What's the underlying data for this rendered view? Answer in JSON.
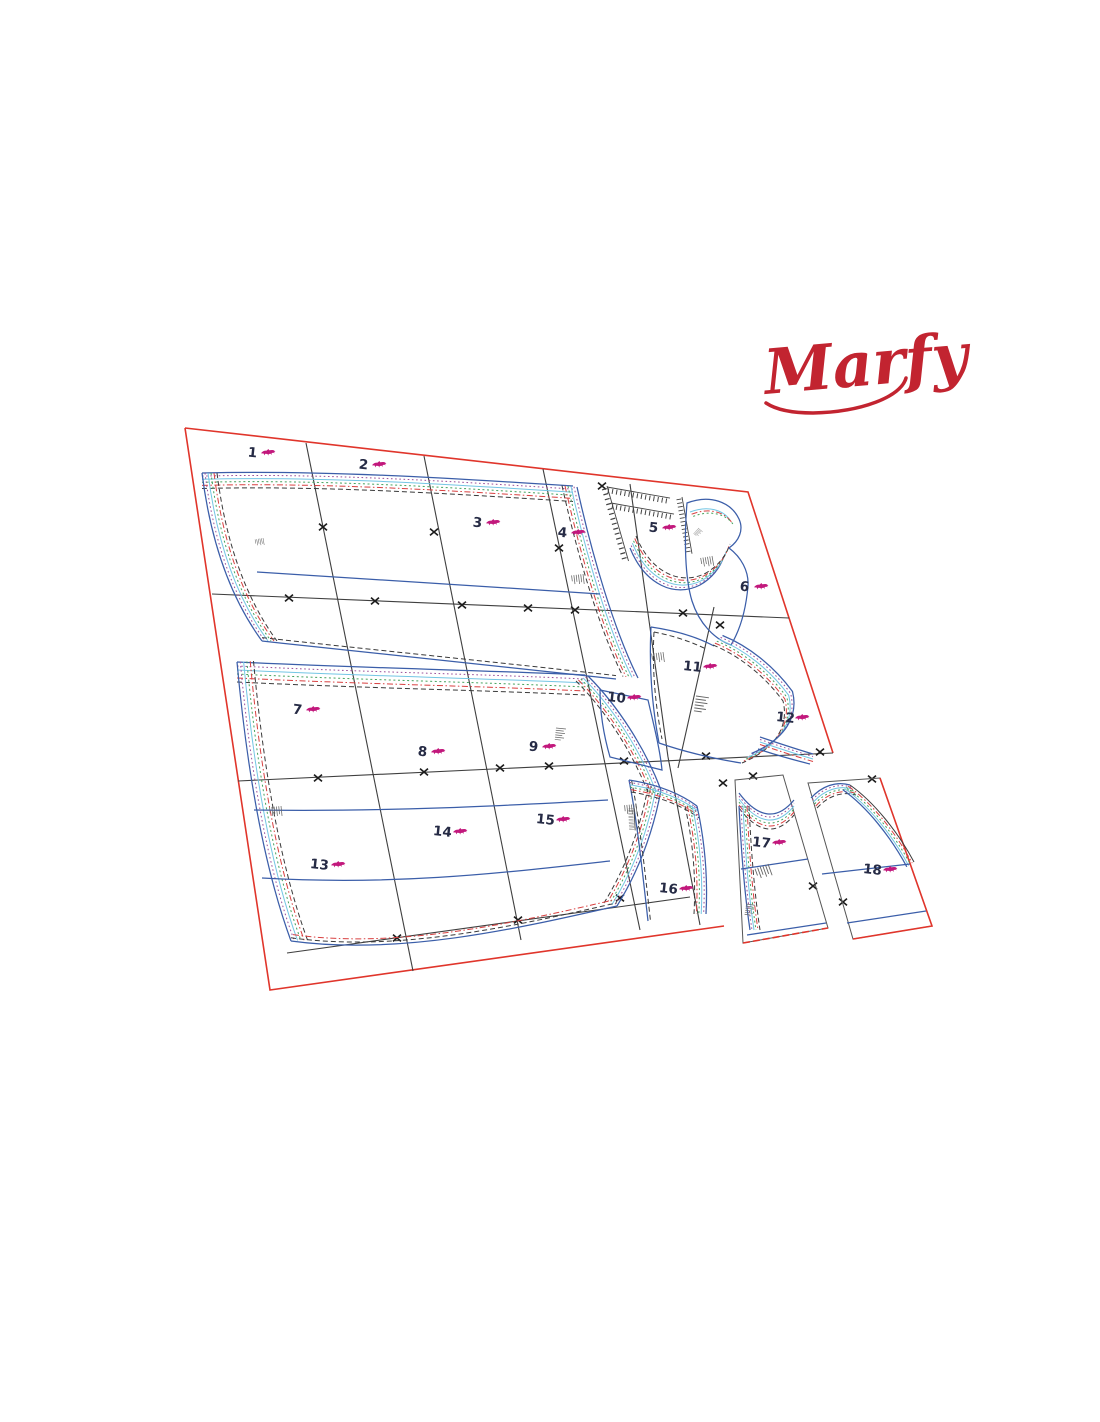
{
  "logo": {
    "text": "Marfy",
    "color": "#c22430"
  },
  "sheet": {
    "piece_numbers": [
      "1",
      "2",
      "3",
      "4",
      "5",
      "6",
      "7",
      "8",
      "9",
      "10",
      "11",
      "12",
      "13",
      "14",
      "15",
      "16",
      "17",
      "18"
    ],
    "border_color": "#e0352b",
    "grid_color": "#3f3f3f",
    "intersection_marker": "x",
    "number_color": "#262b45",
    "horse_icon_color": "#c2187c",
    "size_line_colors": {
      "blue": "#3b5ea9",
      "purple": "#9a4f9a",
      "cyan": "#74c6e4",
      "green": "#46a35e",
      "red": "#d84040",
      "black": "#3a3a3a"
    }
  }
}
